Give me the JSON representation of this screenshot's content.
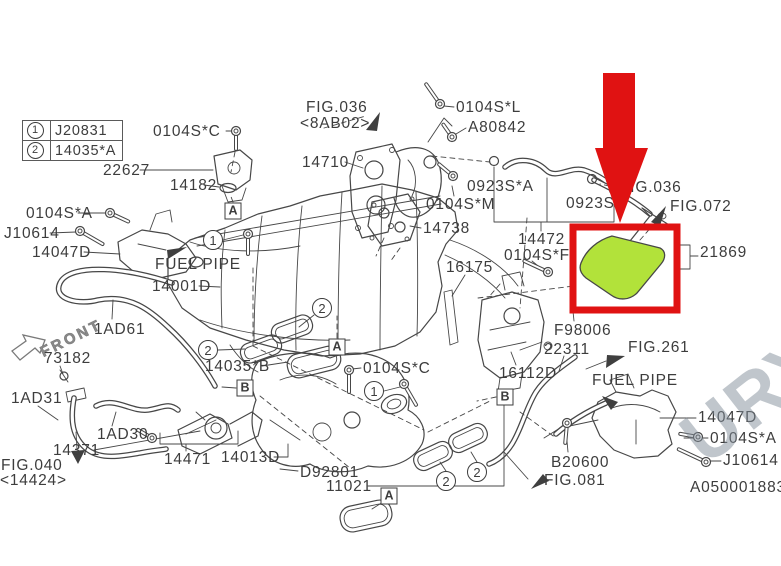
{
  "legend": {
    "rows": [
      {
        "num": "1",
        "code": "J20831"
      },
      {
        "num": "2",
        "code": "14035*A"
      }
    ]
  },
  "front": {
    "text": "FRONT"
  },
  "watermark": {
    "text": "URY"
  },
  "highlight": {
    "part_number": "21869",
    "hose_color": "#b2e23a",
    "box_color": "#e01212",
    "arrow_color": "#e01212"
  },
  "labels": [
    {
      "text": "0104S*C",
      "x": 153,
      "y": 124
    },
    {
      "text": "22627",
      "x": 103,
      "y": 163
    },
    {
      "text": "14182",
      "x": 170,
      "y": 178
    },
    {
      "text": "0104S*A",
      "x": 26,
      "y": 206
    },
    {
      "text": "J10614",
      "x": 4,
      "y": 226
    },
    {
      "text": "14047D",
      "x": 32,
      "y": 245
    },
    {
      "text": "FUEL PIPE",
      "x": 155,
      "y": 257
    },
    {
      "text": "14001D",
      "x": 152,
      "y": 279
    },
    {
      "text": "1AD61",
      "x": 94,
      "y": 322
    },
    {
      "text": "73182",
      "x": 44,
      "y": 351
    },
    {
      "text": "1AD31",
      "x": 11,
      "y": 391
    },
    {
      "text": "1AD30",
      "x": 97,
      "y": 427
    },
    {
      "text": "14371",
      "x": 53,
      "y": 443
    },
    {
      "text": "FIG.040",
      "x": 1,
      "y": 458
    },
    {
      "text": "<14424>",
      "x": 0,
      "y": 473
    },
    {
      "text": "14471",
      "x": 164,
      "y": 452
    },
    {
      "text": "14013D",
      "x": 221,
      "y": 450
    },
    {
      "text": "D92801",
      "x": 300,
      "y": 465
    },
    {
      "text": "11021",
      "x": 326,
      "y": 479
    },
    {
      "text": "14035*B",
      "x": 205,
      "y": 359
    },
    {
      "text": "0104S*C",
      "x": 363,
      "y": 361
    },
    {
      "text": "FIG.036",
      "x": 306,
      "y": 100
    },
    {
      "text": "<8AB02>",
      "x": 300,
      "y": 116
    },
    {
      "text": "14710",
      "x": 302,
      "y": 155
    },
    {
      "text": "0104S*L",
      "x": 456,
      "y": 100
    },
    {
      "text": "A80842",
      "x": 468,
      "y": 120
    },
    {
      "text": "0104S*M",
      "x": 426,
      "y": 197
    },
    {
      "text": "0923S*A",
      "x": 467,
      "y": 179
    },
    {
      "text": "14738",
      "x": 423,
      "y": 221
    },
    {
      "text": "0923S",
      "x": 566,
      "y": 196
    },
    {
      "text": "14472",
      "x": 518,
      "y": 232
    },
    {
      "text": "0104S*F",
      "x": 504,
      "y": 248
    },
    {
      "text": "16175",
      "x": 446,
      "y": 260
    },
    {
      "text": "FIG.036",
      "x": 620,
      "y": 180
    },
    {
      "text": "FIG.072",
      "x": 670,
      "y": 199
    },
    {
      "text": "21869",
      "x": 700,
      "y": 245
    },
    {
      "text": "F98006",
      "x": 554,
      "y": 323
    },
    {
      "text": "22311",
      "x": 544,
      "y": 342
    },
    {
      "text": "FIG.261",
      "x": 628,
      "y": 340
    },
    {
      "text": "16112D",
      "x": 499,
      "y": 366
    },
    {
      "text": "FUEL PIPE",
      "x": 592,
      "y": 373
    },
    {
      "text": "14047D",
      "x": 698,
      "y": 410
    },
    {
      "text": "0104S*A",
      "x": 710,
      "y": 431
    },
    {
      "text": "J10614",
      "x": 723,
      "y": 453
    },
    {
      "text": "B20600",
      "x": 551,
      "y": 455
    },
    {
      "text": "FIG.081",
      "x": 544,
      "y": 473
    },
    {
      "text": "A050001883",
      "x": 690,
      "y": 480
    }
  ],
  "callouts": {
    "circles": [
      {
        "n": "1",
        "x": 213,
        "y": 240
      },
      {
        "n": "1",
        "x": 374,
        "y": 391
      },
      {
        "n": "2",
        "x": 322,
        "y": 308
      },
      {
        "n": "2",
        "x": 208,
        "y": 350
      },
      {
        "n": "2",
        "x": 446,
        "y": 481
      },
      {
        "n": "2",
        "x": 477,
        "y": 472
      }
    ],
    "boxes": [
      {
        "l": "A",
        "x": 233,
        "y": 211
      },
      {
        "l": "A",
        "x": 337,
        "y": 347
      },
      {
        "l": "A",
        "x": 389,
        "y": 496
      },
      {
        "l": "B",
        "x": 245,
        "y": 388
      },
      {
        "l": "B",
        "x": 505,
        "y": 397
      }
    ]
  }
}
